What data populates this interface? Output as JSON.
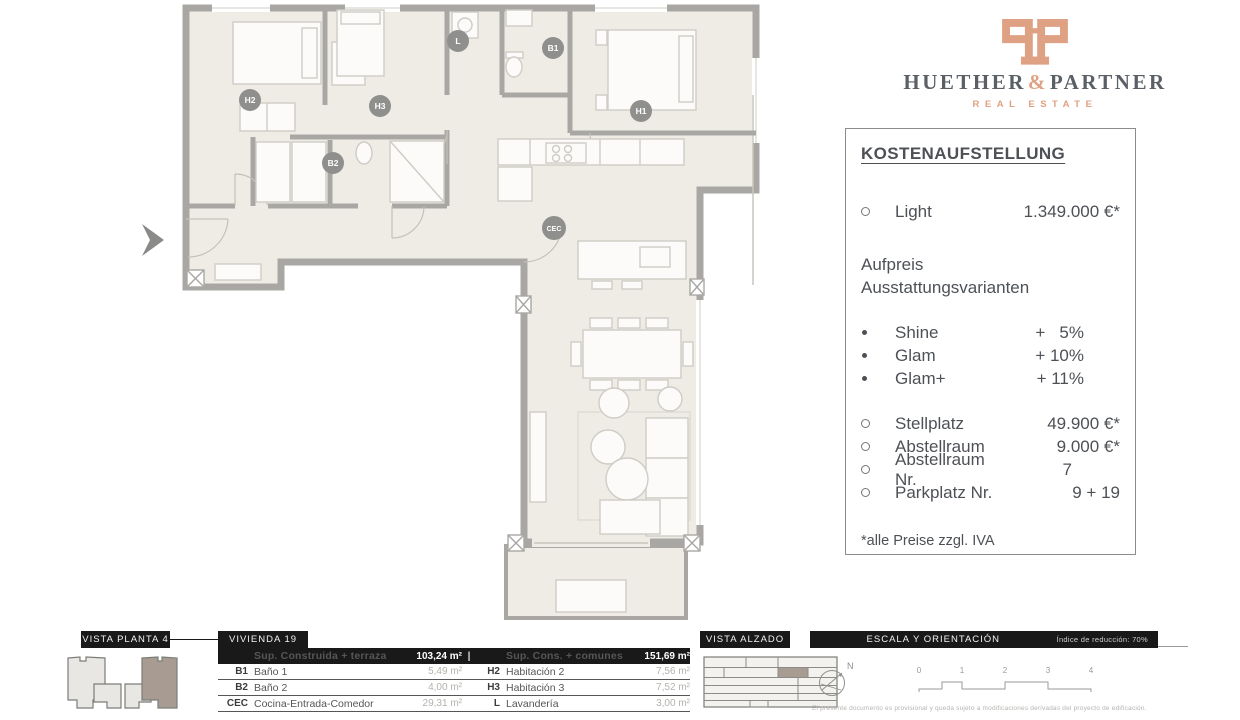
{
  "logo": {
    "name_left": "HUETHER",
    "amp": "&",
    "name_right": "PARTNER",
    "subtitle": "REAL ESTATE",
    "accent_color": "#dfa183",
    "text_color": "#5b6067"
  },
  "cost_panel": {
    "title": "KOSTENAUFSTELLUNG",
    "base": {
      "label": "Light",
      "value": "1.349.000 €*"
    },
    "upgrade_heading_line1": "Aufpreis",
    "upgrade_heading_line2": "Ausstattungsvarianten",
    "upgrades": [
      {
        "label": "Shine",
        "value": "+   5%"
      },
      {
        "label": "Glam",
        "value": "+ 10%"
      },
      {
        "label": "Glam+",
        "value": "+ 11%"
      }
    ],
    "extras": [
      {
        "label": "Stellplatz",
        "value": "49.900 €*"
      },
      {
        "label": "Abstellraum",
        "value": "9.000 €*"
      },
      {
        "label": "Abstellraum Nr.",
        "value": "7"
      },
      {
        "label": "Parkplatz Nr.",
        "value": "9 + 19"
      }
    ],
    "footnote": "*alle Preise zzgl. IVA"
  },
  "floor_plan": {
    "room_labels": [
      {
        "id": "H2"
      },
      {
        "id": "B2"
      },
      {
        "id": "H3"
      },
      {
        "id": "L"
      },
      {
        "id": "B1"
      },
      {
        "id": "H1"
      },
      {
        "id": "CEC"
      }
    ],
    "colors": {
      "floor": "#efece5",
      "wall": "#a9a7a3",
      "label_circle": "#8f8f8d",
      "highlight": "#a89c92"
    }
  },
  "footer": {
    "vista_planta": {
      "title": "VISTA PLANTA 4"
    },
    "vivienda": {
      "title": "VIVIENDA 19",
      "header": {
        "left_label": "Sup. Construida + terraza",
        "left_value": "103,24 m²",
        "divider": "|",
        "right_label": "Sup. Cons. + comunes",
        "right_value": "151,69 m²"
      },
      "rows": [
        {
          "code": "B1",
          "name": "Baño 1",
          "value": "5,49 m²",
          "code2": "H2",
          "name2": "Habitación 2",
          "value2": "7,56 m²"
        },
        {
          "code": "B2",
          "name": "Baño 2",
          "value": "4,00 m²",
          "code2": "H3",
          "name2": "Habitación 3",
          "value2": "7,52 m²"
        },
        {
          "code": "CEC",
          "name": "Cocina-Entrada-Comedor",
          "value": "29,31 m²",
          "code2": "L",
          "name2": "Lavandería",
          "value2": "3,00 m²"
        }
      ]
    },
    "vista_alzado": {
      "title": "VISTA ALZADO"
    },
    "escala": {
      "title": "ESCALA Y ORIENTACIÓN",
      "reduction": "Índice de reducción: 70%",
      "compass_label": "N",
      "scale_ticks": [
        "0",
        "1",
        "2",
        "3",
        "4"
      ],
      "fine_print": "El presente documento es provisional y queda sujeto a modificaciones derivadas del proyecto de edificación."
    }
  }
}
